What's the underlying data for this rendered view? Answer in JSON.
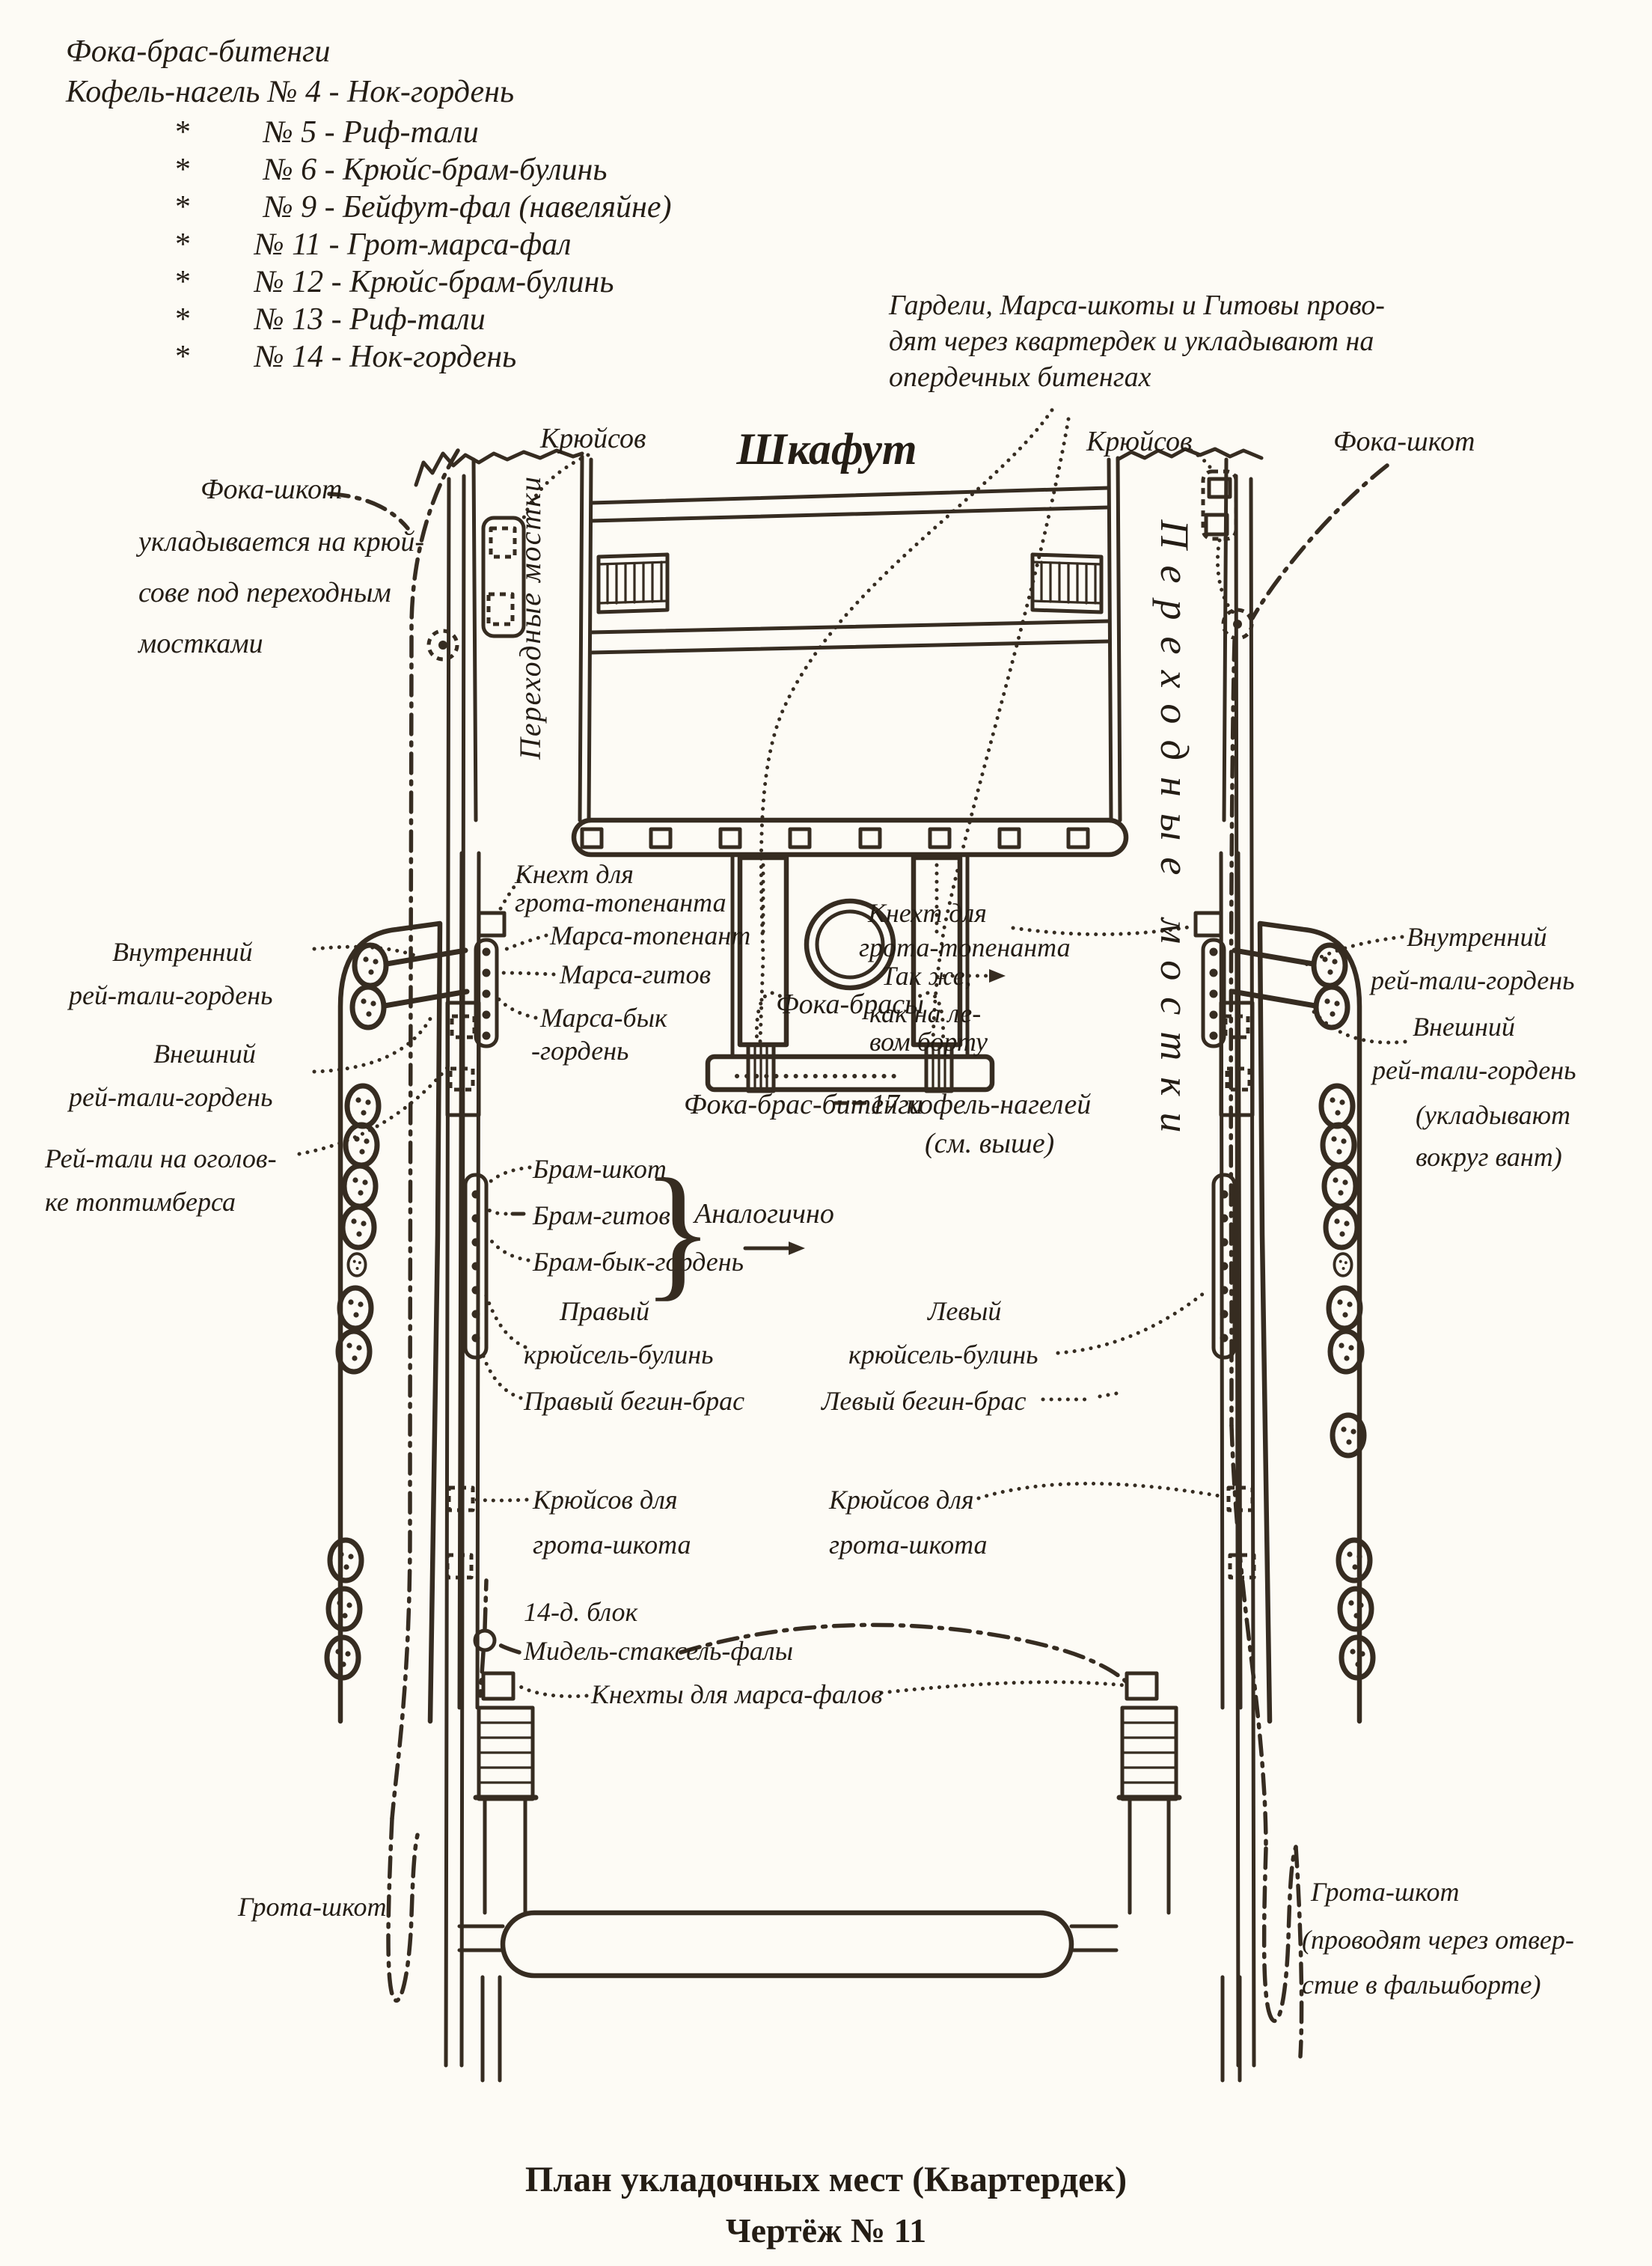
{
  "page": {
    "bg": "#fdfbf5",
    "ink": "#362c21"
  },
  "top_list": {
    "title": "Фока-брас-битенги",
    "intro": "Кофель-нагель № 4 - Нок-гордень",
    "star": "*",
    "items": [
      "№ 5 - Риф-тали",
      "№ 6 - Крюйс-брам-булинь",
      "№ 9 - Бейфут-фал (навеляйне)",
      "№ 11 - Грот-марса-фал",
      "№ 12 - Крюйс-брам-булинь",
      "№ 13 - Риф-тали",
      "№ 14 - Нок-гордень"
    ]
  },
  "note_right": {
    "line1": "Гардели, Марса-шкоты и Гитовы прово-",
    "line2": "дят через квартердек и укладывают на",
    "line3": "опердечных битенгах"
  },
  "labels": {
    "shkafut": "Шкафут",
    "kryusov_left": "Крюйсов",
    "kryusov_right": "Крюйсов",
    "foka_shkot_right": "Фока-шкот",
    "foka_note1": "Фока-шкот",
    "foka_note2": "укладывается на крюй-",
    "foka_note3": "сове под переходным",
    "foka_note4": "мостками",
    "vert_left": "Переходные мостки",
    "vert_right": "Переходные мостки",
    "kneht_left1": "Кнехт для",
    "kneht_left2": "грота-топенанта",
    "marsa_topenant": "Марса-топенант",
    "marsa_gitov": "Марса-гитов",
    "marsa_byk1": "Марса-бык",
    "marsa_byk2": "-гордень",
    "foka_brasy": "Фока-брасы",
    "kneht_right1": "Кнехт для",
    "kneht_right2": "грота-топенанта",
    "takzhe1": "Так же,",
    "takzhe2": "как на ле-",
    "takzhe3": "вом борту",
    "fbb": "Фока-брас-битенги",
    "nageli1": "17 кофель-нагелей",
    "nageli2": "(см. выше)",
    "vnutr1": "Внутренний",
    "vnutr2": "рей-тали-гордень",
    "vnesh1": "Внешний",
    "vnesh2": "рей-тали-гордень",
    "reytali1": "Рей-тали на оголов-",
    "reytali2": "ке топтимберса",
    "r_vnutr1": "Внутренний",
    "r_vnutr2": "рей-тали-гордень",
    "r_vnesh1": "Внешний",
    "r_vnesh2": "рей-тали-гордень",
    "r_vnesh3": "(укладывают",
    "r_vnesh4": "вокруг вант)",
    "bram1": "Брам-шкот",
    "bram2": "Брам-гитов",
    "bram3": "Брам-бык-гордень",
    "brace": "}",
    "analog": "Аналогично",
    "prav_kr1": "Правый",
    "prav_kr2": "крюйсель-булинь",
    "lev_kr1": "Левый",
    "lev_kr2": "крюйсель-булинь",
    "prav_begin": "Правый бегин-брас",
    "lev_begin": "Левый бегин-брас",
    "kr_grota_l1": "Крюйсов для",
    "kr_grota_l2": "грота-шкота",
    "kr_grota_r1": "Крюйсов для",
    "kr_grota_r2": "грота-шкота",
    "blok": "14-д. блок",
    "midel": "Мидель-стаксель-фалы",
    "knehty": "Кнехты для марса-фалов",
    "grota_l": "Грота-шкот",
    "grota_r1": "Грота-шкот",
    "grota_r2": "(проводят через отвер-",
    "grota_r3": "стие в фальшборте)"
  },
  "caption": {
    "line1": "План укладочных мест (Квартердек)",
    "line2": "Чертёж № 11"
  }
}
